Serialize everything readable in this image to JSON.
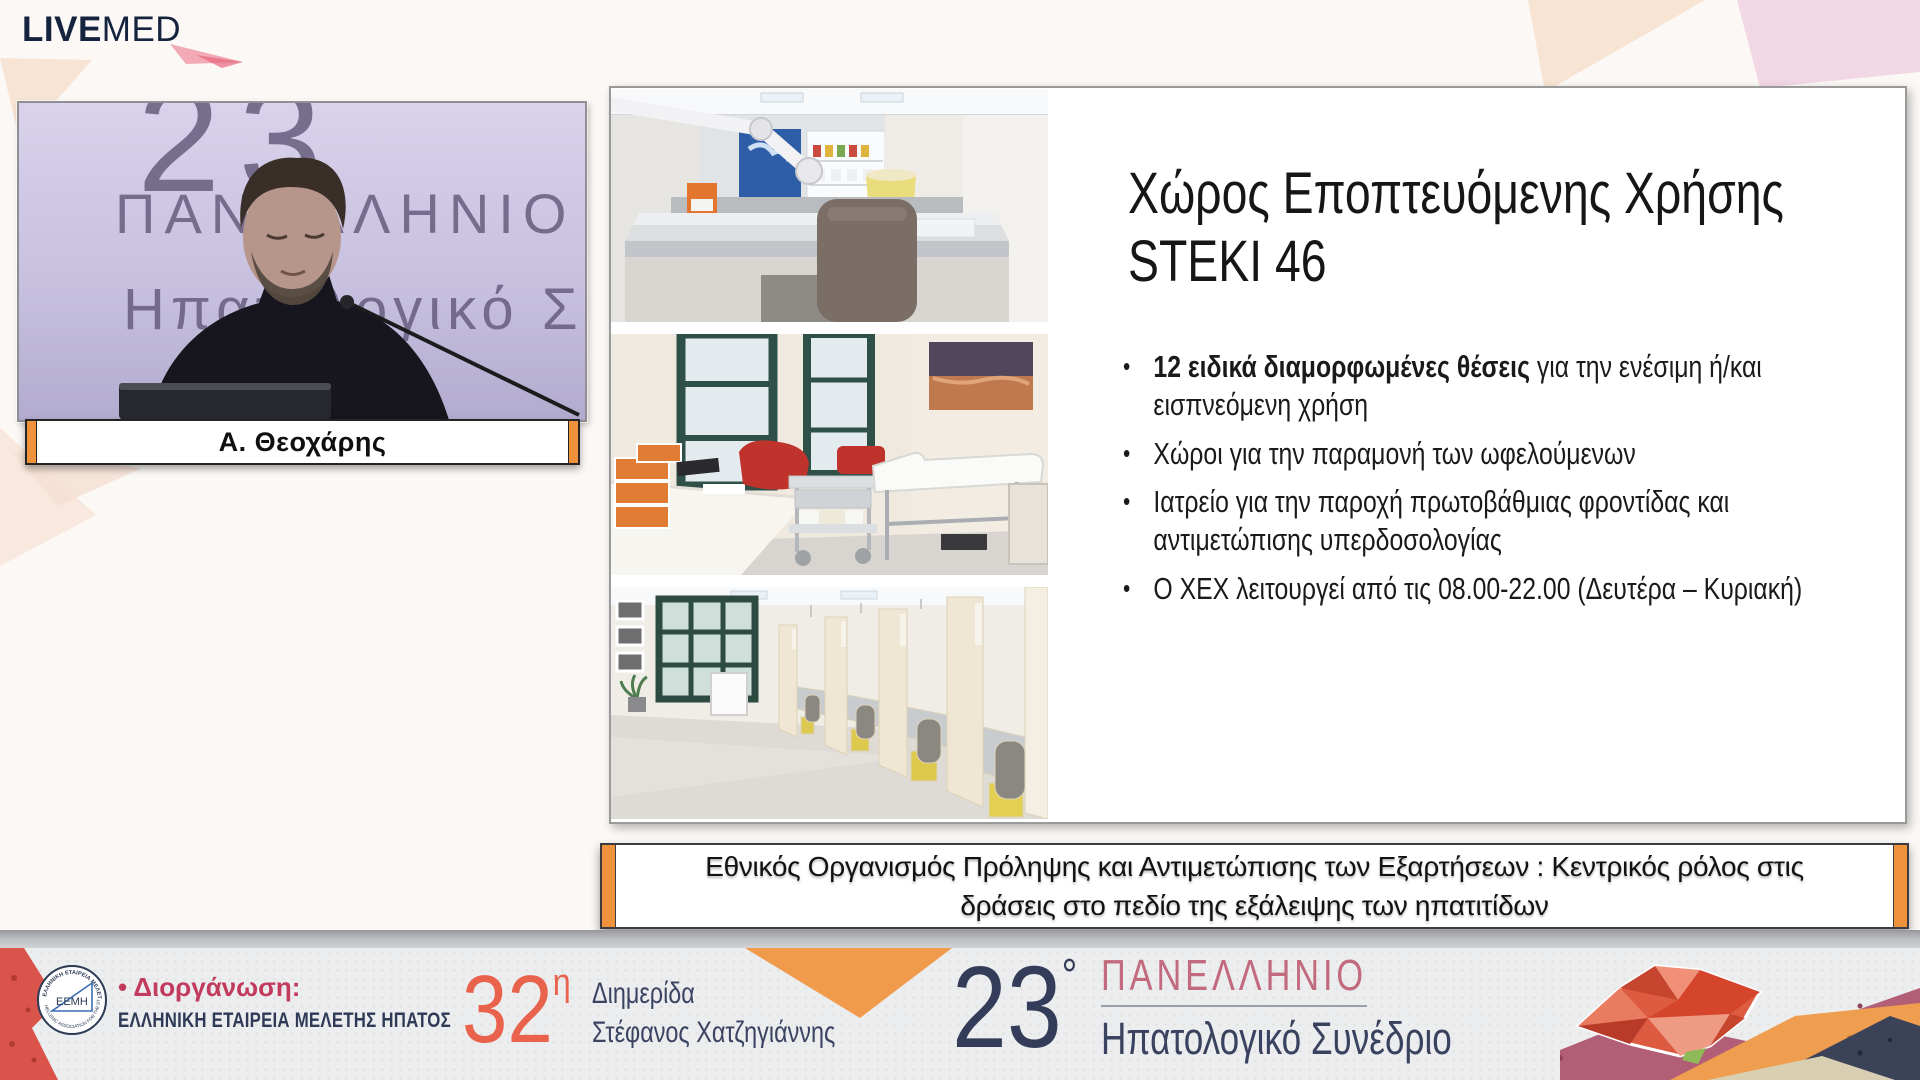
{
  "brand": {
    "live": "LIVE",
    "med": "MED"
  },
  "video": {
    "backdrop": {
      "line1": "23",
      "line2": "ΠΑΝΕΛΛΗΝΙΟ",
      "line3": "Ηπατολογικό Σ"
    },
    "speaker_name": "Α. Θεοχάρης"
  },
  "slide": {
    "title_line1": "Χώρος Εποπτευόμενης Χρήσης",
    "title_line2": "STEKI 46",
    "bullets": [
      {
        "bold": "12 ειδικά διαμορφωμένες θέσεις",
        "text": " για την ενέσιμη ή/και εισπνεόμενη χρήση"
      },
      {
        "bold": "",
        "text": "Χώροι για την παραμονή των ωφελούμενων"
      },
      {
        "bold": "",
        "text": "Ιατρείο για την παροχή πρωτοβάθμιας φροντίδας και αντιμετώπισης υπερδοσολογίας"
      },
      {
        "bold": "",
        "text": "Ο ΧΕΧ λειτουργεί από τις 08.00-22.00 (Δευτέρα – Κυριακή)"
      }
    ],
    "photos": [
      "injection-booth-closeup",
      "medical-exam-room",
      "supervised-use-booth-row"
    ]
  },
  "banner": {
    "line1": "Εθνικός Οργανισμός Πρόληψης και Αντιμετώπισης των Εξαρτήσεων : Κεντρικός ρόλος στις",
    "line2": "δράσεις στο πεδίο της εξάλειψης των ηπατιτίδων"
  },
  "footer": {
    "organizer_label": "• Διοργάνωση:",
    "organizer_name": "ΕΛΛΗΝΙΚΗ ΕΤΑΙΡΕΙΑ ΜΕΛΕΤΗΣ ΗΠΑΤΟΣ",
    "eemh_logo": {
      "center": "ΕΕΜΗ",
      "ring_top": "ΕΛΛΗΝΙΚΗ ΕΤΑΙΡΕΙΑ ΜΕΛΕΤΗΣ ΗΠΑΤΟΣ",
      "ring_bottom": "HELLENIC ASSOCIATION FOR THE STUDY OF LIVER"
    },
    "event_32": {
      "number": "32",
      "sup": "η",
      "line1": "Διημερίδα",
      "line2": "Στέφανος Χατζηγιάννης"
    },
    "event_23": {
      "number": "23",
      "sup": "°",
      "line1": "ΠΑΝΕΛΛΗΝΙΟ",
      "line2": "Ηπατολογικό Συνέδριο"
    }
  },
  "colors": {
    "brand_navy": "#15233f",
    "accent_orange": "#f0923b",
    "coral": "#e8624c",
    "rose": "#c26a7e",
    "crimson": "#c23a5c",
    "footer_navy": "#39425e",
    "backdrop_lavender": "#c7c0df",
    "footer_grey": "#ecedee",
    "liver_coral": "#dd5b41"
  }
}
